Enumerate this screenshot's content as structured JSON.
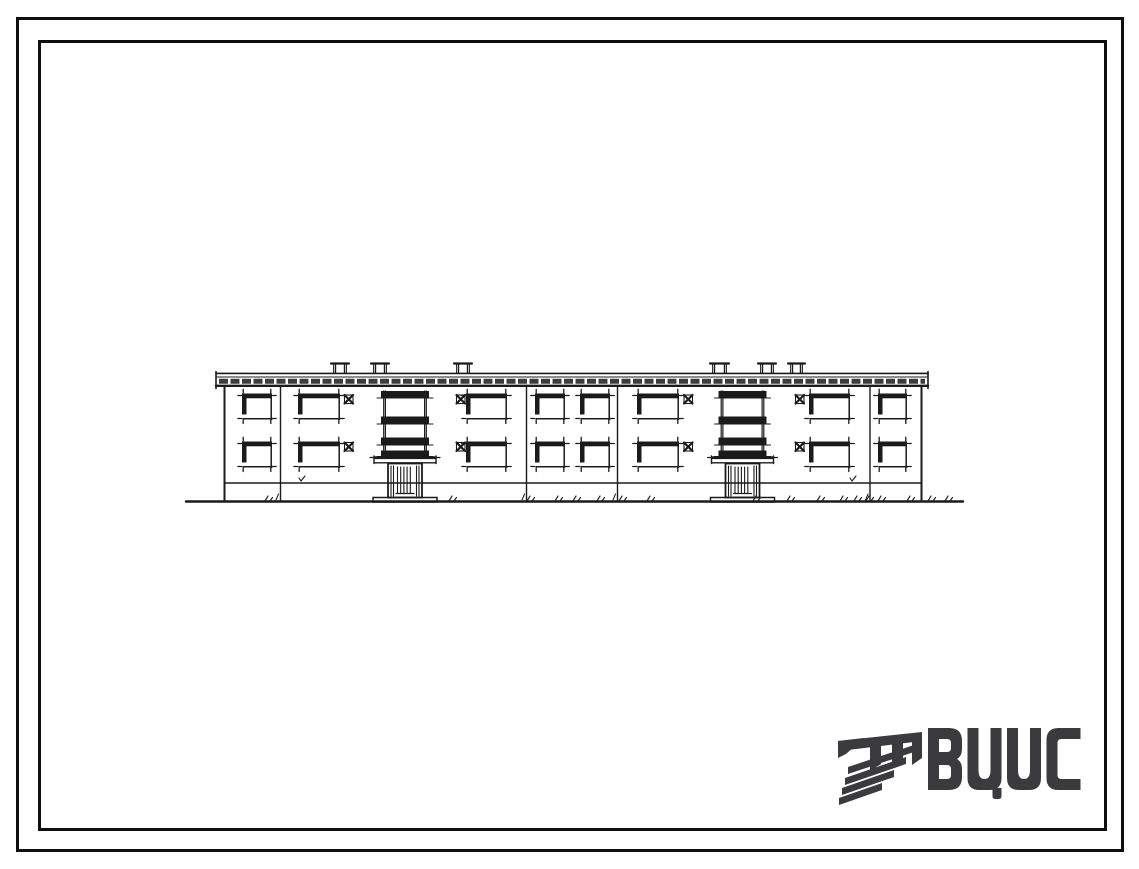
{
  "sheet": {
    "background": "#ffffff",
    "border_color": "#0f0f0f"
  },
  "logo": {
    "text": "ВЦИС",
    "letters": [
      "В",
      "Ц",
      "И",
      "С"
    ],
    "color": "#3b3b3d",
    "mark": "diagonal-stripes-monogram"
  },
  "drawing": {
    "title": "two-storey two-entrance building facade elevation, ink on white",
    "ink": "#1b1b1b",
    "floors": 2,
    "entrances_count": 2,
    "ground": {
      "x1": 186,
      "x2": 963,
      "y": 501.5
    },
    "cornice": {
      "x1": 216,
      "x2": 928
    },
    "wall": {
      "x1": 224.5,
      "x2": 921.5,
      "top": 386,
      "plinth_y": 483
    },
    "joints": [
      280.5,
      526.5,
      617.5,
      870
    ],
    "vents": [
      {
        "x": 333,
        "w": 14
      },
      {
        "x": 373,
        "w": 14
      },
      {
        "x": 456,
        "w": 14
      },
      {
        "x": 712,
        "w": 15
      },
      {
        "x": 760,
        "w": 14
      },
      {
        "x": 790,
        "w": 13
      }
    ],
    "floor_y": [
      393.5,
      441.5
    ],
    "vent_window_y": [
      395,
      442.5
    ],
    "window_h": 26,
    "windows": [
      {
        "type": "square",
        "x": 242,
        "w": 30
      },
      {
        "type": "wide",
        "x": 298,
        "w": 42
      },
      {
        "type": "vent",
        "x": 344.5
      },
      {
        "type": "vent",
        "x": 456.5
      },
      {
        "type": "wide",
        "x": 466,
        "w": 41
      },
      {
        "type": "square",
        "x": 535,
        "w": 30
      },
      {
        "type": "square",
        "x": 580,
        "w": 30
      },
      {
        "type": "wide",
        "x": 637,
        "w": 42
      },
      {
        "type": "vent",
        "x": 684
      },
      {
        "type": "vent",
        "x": 795.5
      },
      {
        "type": "wide",
        "x": 809,
        "w": 41
      },
      {
        "type": "square",
        "x": 878,
        "w": 29
      }
    ],
    "entrances": [
      {
        "x": 383
      },
      {
        "x": 720.5
      }
    ],
    "entrance": {
      "stack_w": 44,
      "bars": [
        [
          391,
          7.5
        ],
        [
          416.5,
          8
        ],
        [
          437.5,
          8
        ],
        [
          450.5,
          6.5
        ]
      ],
      "canopy_overhang": 9,
      "door_inset": 5,
      "door_top": 463.5,
      "door_h": 34
    },
    "grass": [
      268,
      452,
      530,
      558,
      576,
      600,
      622,
      650,
      756,
      790,
      820,
      843,
      857,
      869,
      881,
      910,
      931,
      948
    ],
    "wall_marks": [
      {
        "x": 302,
        "y": 478
      },
      {
        "x": 853,
        "y": 478
      }
    ]
  }
}
